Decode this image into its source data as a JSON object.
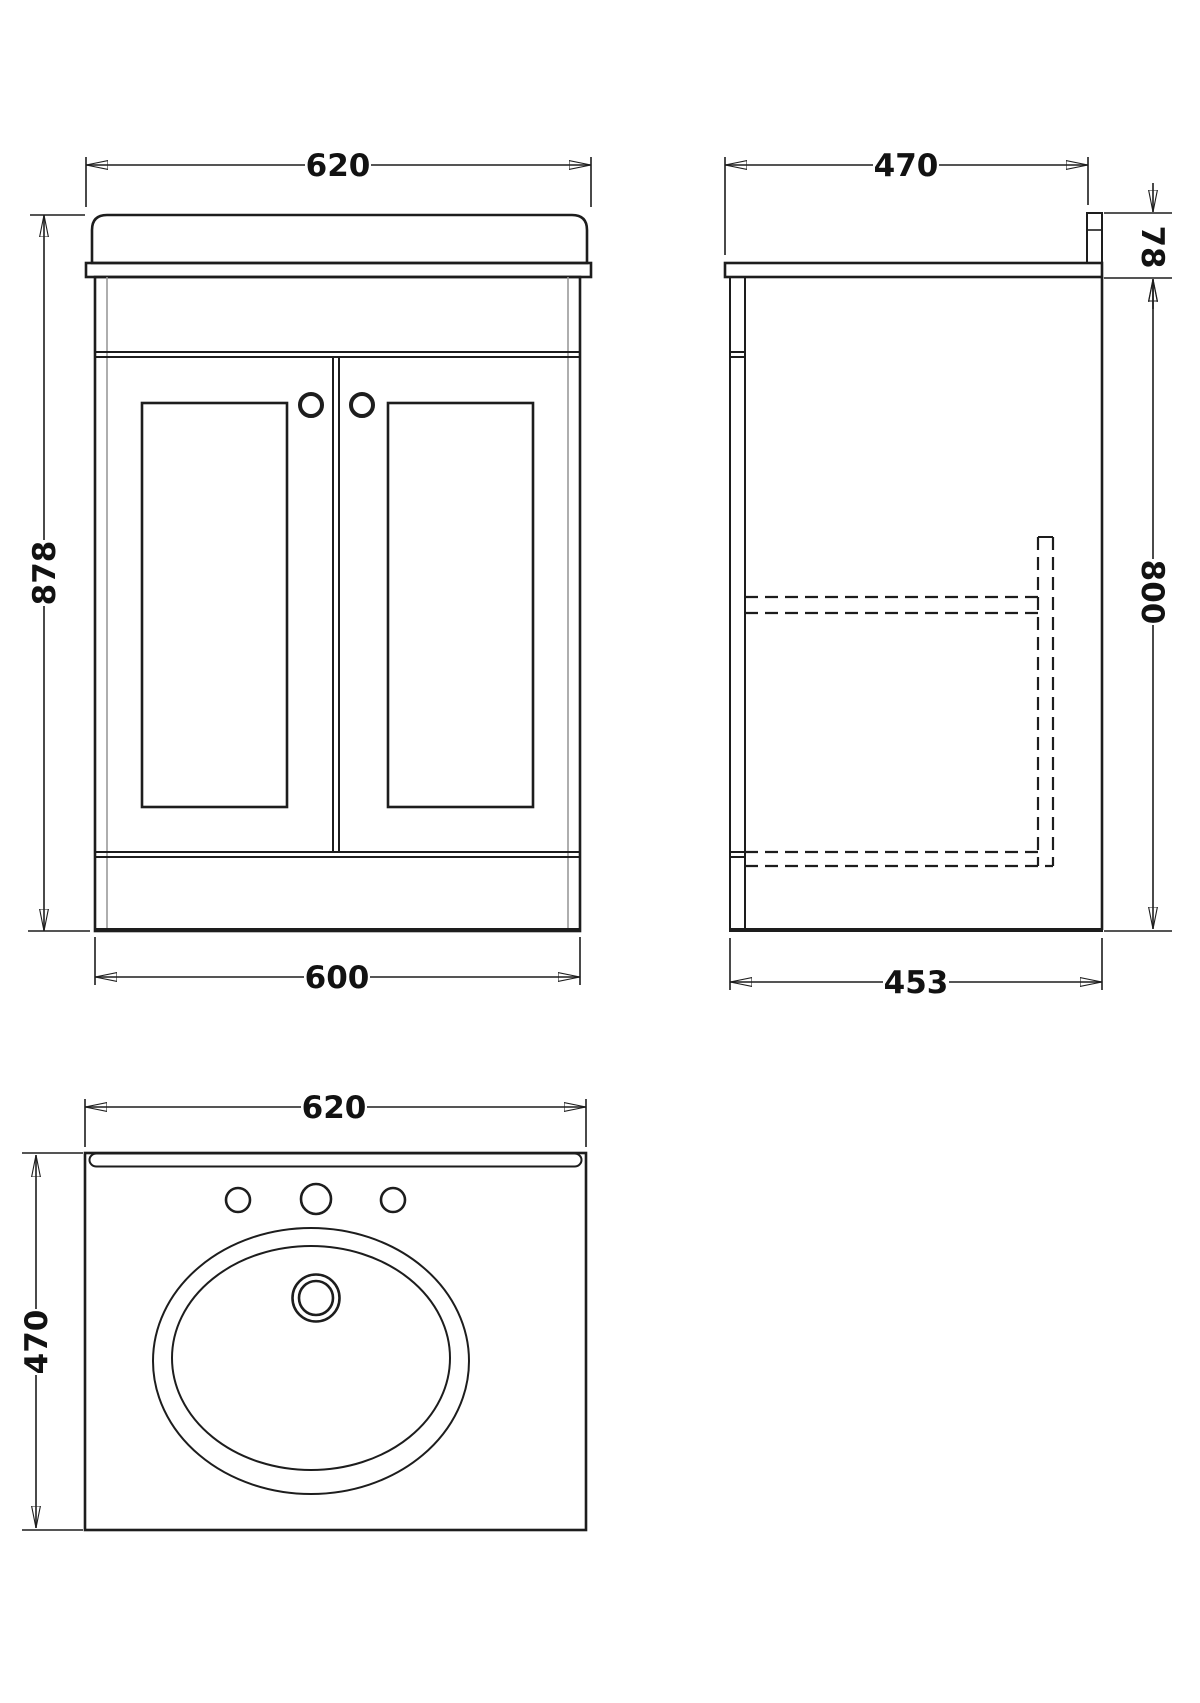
{
  "page": {
    "background": "#ffffff",
    "ink": "#1d1d1d",
    "accent_light_line": "#9a9a9a"
  },
  "drawing": {
    "views": {
      "front": {
        "dims": {
          "top_width": "620",
          "left_height": "878",
          "bottom_width": "600"
        }
      },
      "side": {
        "dims": {
          "top_depth": "470",
          "worktop_height": "78",
          "cabinet_height": "800",
          "bottom_depth": "453"
        }
      },
      "plan": {
        "dims": {
          "top_width": "620",
          "left_depth": "470"
        }
      }
    }
  }
}
